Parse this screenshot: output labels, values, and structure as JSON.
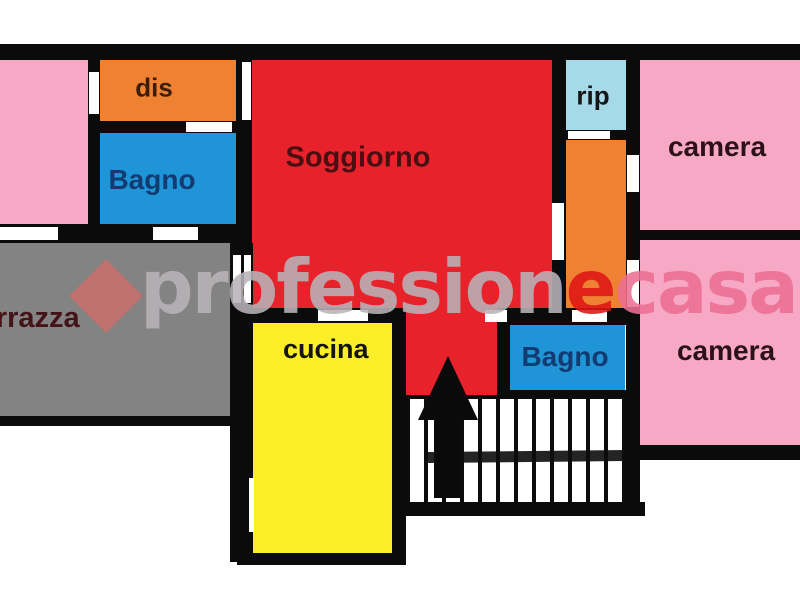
{
  "rooms": {
    "dis": {
      "label": "dis"
    },
    "bagno1": {
      "label": "Bagno"
    },
    "soggiorno": {
      "label": "Soggiorno"
    },
    "rip": {
      "label": "rip"
    },
    "camera1": {
      "label": "camera"
    },
    "camera2": {
      "label": "camera"
    },
    "terrazza": {
      "label": "terrazza"
    },
    "cucina": {
      "label": "cucina"
    },
    "bagno2": {
      "label": "Bagno"
    }
  },
  "watermark": {
    "full": "professionecasa",
    "part_gray": "profession",
    "part_red": "e",
    "part_pink": "casa"
  },
  "colors": {
    "wall": "#0b0b0b",
    "bedroom_pink": "#f6a8c5",
    "soggiorno_red": "#e7222a",
    "dis_orange": "#ef8133",
    "bagno_blue": "#1f95d8",
    "rip_lightblue": "#a7dae9",
    "cucina_yellow": "#fbee27",
    "terrazza_gray": "#838383",
    "watermark_gray": "#b9b3b8",
    "watermark_red": "#e01515",
    "watermark_pink": "#ec6f94",
    "logo_diamond": "#c5716d"
  }
}
